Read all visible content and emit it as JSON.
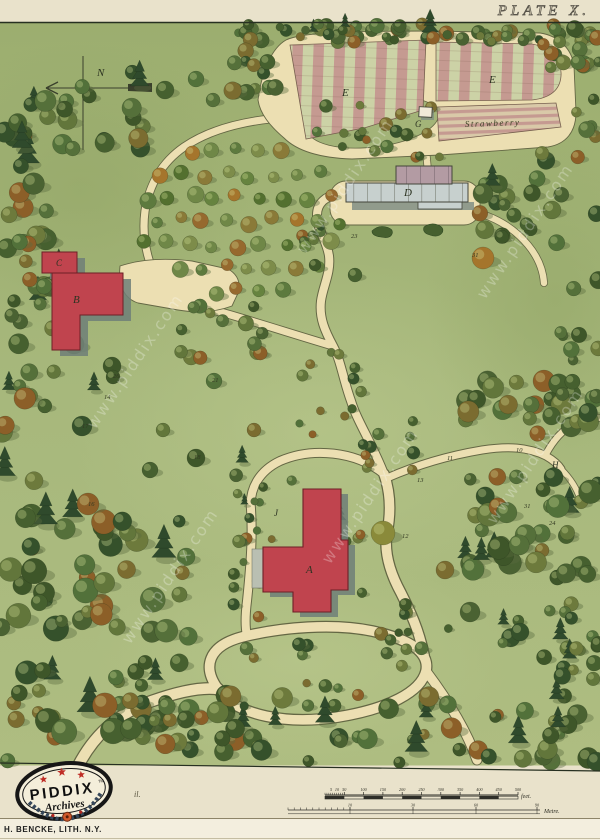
{
  "plate_title": "PLATE X.",
  "watermark": "www.piddix.com",
  "compass": {
    "letter": "N"
  },
  "map": {
    "labels": {
      "bedE_left": "E",
      "bedE_right": "E",
      "strawberry": "Strawberry",
      "structureG": "G",
      "greenhouseD": "D",
      "houseA": "A",
      "houseB": "B",
      "houseC": "C",
      "pointH": "H",
      "pointJ": "J"
    },
    "numbers": [
      {
        "t": "23",
        "x": 351,
        "y": 238
      },
      {
        "t": "31",
        "x": 472,
        "y": 257
      },
      {
        "t": "26",
        "x": 113,
        "y": 378
      },
      {
        "t": "21",
        "x": 212,
        "y": 382
      },
      {
        "t": "14",
        "x": 104,
        "y": 399
      },
      {
        "t": "17",
        "x": 82,
        "y": 428
      },
      {
        "t": "18",
        "x": 194,
        "y": 459
      },
      {
        "t": "16",
        "x": 88,
        "y": 506
      },
      {
        "t": "10",
        "x": 516,
        "y": 452
      },
      {
        "t": "11",
        "x": 447,
        "y": 460
      },
      {
        "t": "13",
        "x": 417,
        "y": 482
      },
      {
        "t": "31",
        "x": 524,
        "y": 508
      },
      {
        "t": "24",
        "x": 549,
        "y": 525
      },
      {
        "t": "12",
        "x": 402,
        "y": 538
      }
    ]
  },
  "scales": {
    "feet": {
      "ticks": [
        "5",
        "10",
        "50",
        "100",
        "150",
        "200",
        "250",
        "300",
        "350",
        "400",
        "450",
        "500"
      ],
      "unit": "feet."
    },
    "metre": {
      "ticks": [
        "10",
        "30",
        "60",
        "90"
      ],
      "unit": "Metre."
    }
  },
  "logo": {
    "name": "PIDDIX",
    "tm": "TM",
    "sub": "Archives"
  },
  "caption_fragment": "il.",
  "credit": "H. BENCKE, LITH. N.Y.",
  "colors": {
    "lawn": "#a7b87c",
    "path_cream": "#ecdfb2",
    "building_red": "#c0444e",
    "shadow_gray": "#7b8a82",
    "stripe_pink": "#c59a91",
    "stripe_green": "#ccd2a6",
    "page_cream": "#e9e2cb"
  }
}
